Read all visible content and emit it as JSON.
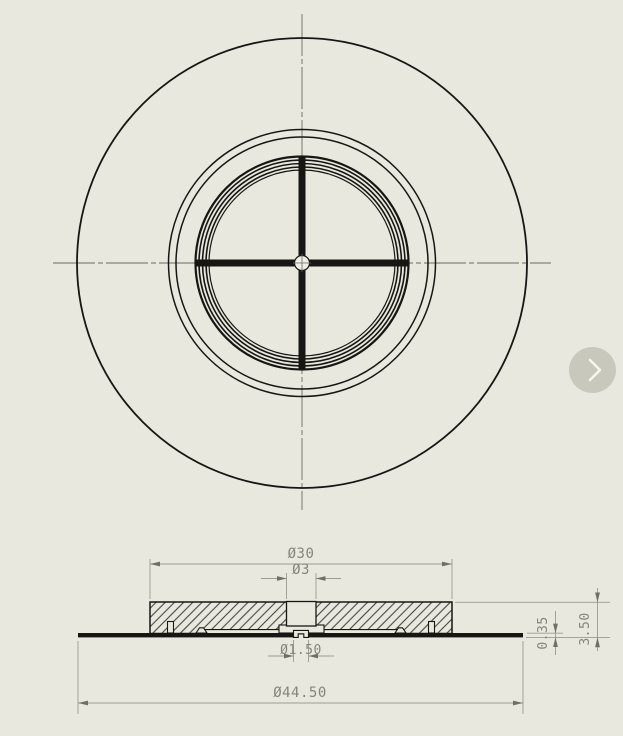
{
  "canvas": {
    "background_color": "#e9e8df",
    "edge_line_color": "#161613",
    "centerline_color": "#6a6a62",
    "dimension_line_color": "#9b9b93",
    "dimension_arrow_color": "#6f6f68",
    "dimension_text_color": "#85857c"
  },
  "drawing": {
    "dimensions": {
      "boss_diameter": "Ø30",
      "top_hole_diameter": "Ø3",
      "center_hole_diameter": "Ø1.50",
      "outer_flange_diameter": "Ø44.50",
      "boss_height": "3.50",
      "plate_thickness": "0.35"
    }
  },
  "next_button": {
    "icon": "chevron-right-icon"
  }
}
